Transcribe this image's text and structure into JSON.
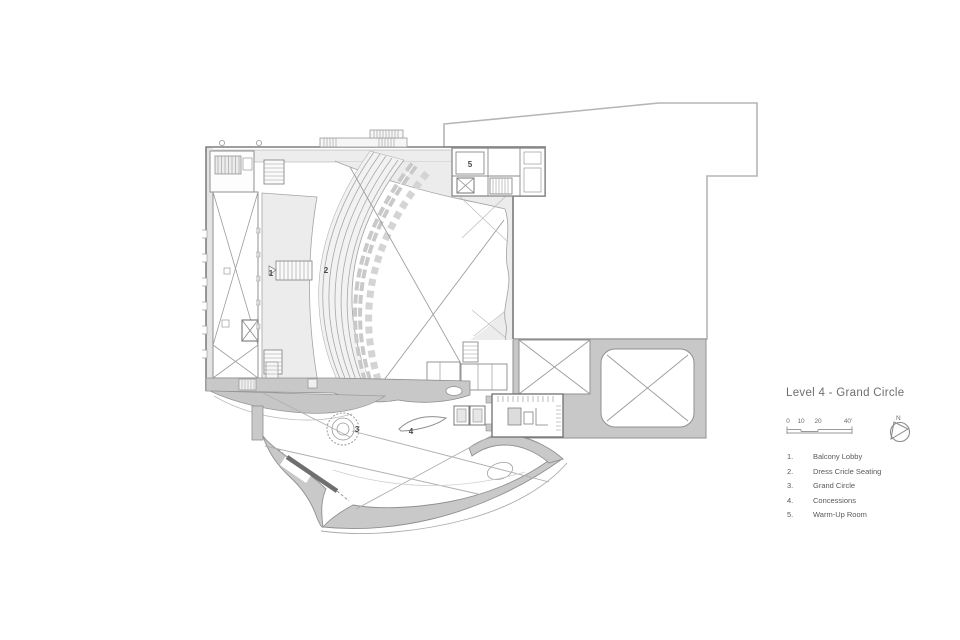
{
  "drawing": {
    "title": "Level 4 - Grand Circle",
    "scale_ticks": [
      "0",
      "10",
      "20",
      "40'"
    ],
    "north_label": "N",
    "legend": [
      {
        "num": "1.",
        "label": "Balcony Lobby"
      },
      {
        "num": "2.",
        "label": "Dress Cricle Seating"
      },
      {
        "num": "3.",
        "label": "Grand Circle"
      },
      {
        "num": "4.",
        "label": "Concessions"
      },
      {
        "num": "5.",
        "label": "Warm-Up Room"
      }
    ],
    "plan_markers": [
      "1",
      "2",
      "3",
      "4",
      "5"
    ],
    "colors": {
      "canopy_gray": "#c9c9c9",
      "podium_gray": "#c8c8c8",
      "poche_gray": "#ececec",
      "wall_line": "#8a8a8a",
      "outline_light": "#b5b5b5",
      "title_text": "#6d6e71",
      "legend_text": "#58595b"
    }
  }
}
